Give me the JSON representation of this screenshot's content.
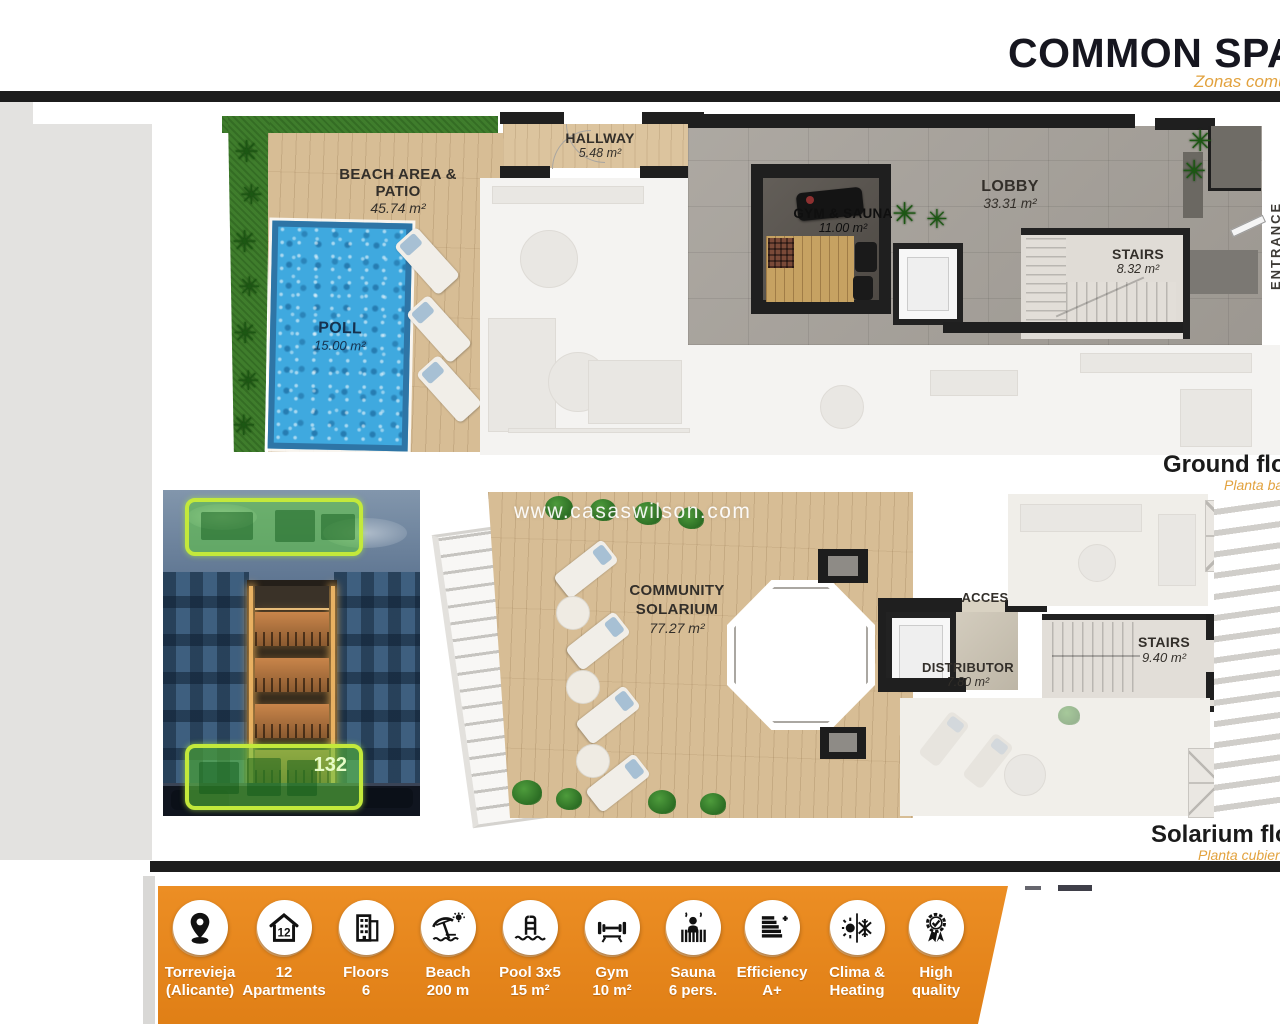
{
  "header": {
    "title": "COMMON SPACES",
    "subtitle": "Zonas comunes"
  },
  "watermark": "www.casaswilson.com",
  "ground_floor": {
    "floor_label": "Ground floor",
    "floor_sublabel": "Planta baja",
    "rooms": {
      "beach": {
        "name": "BEACH AREA & PATIO",
        "area": "45.74 m²"
      },
      "pool": {
        "name": "POLL",
        "area": "15.00 m²"
      },
      "hallway": {
        "name": "HALLWAY",
        "area": "5.48 m²"
      },
      "gym": {
        "name": "GYM & SAUNA",
        "area": "11.00 m²"
      },
      "lobby": {
        "name": "LOBBY",
        "area": "33.31 m²"
      },
      "stairs": {
        "name": "STAIRS",
        "area": "8.32 m²"
      },
      "entrance": {
        "name": "ENTRANCE"
      }
    }
  },
  "solarium_floor": {
    "floor_label": "Solarium floor",
    "floor_sublabel": "Planta cubierta",
    "rooms": {
      "solarium": {
        "name": "COMMUNITY SOLARIUM",
        "area": "77.27 m²"
      },
      "acces": {
        "name": "ACCES"
      },
      "distributor": {
        "name": "DISTRIBUTOR",
        "area": "7.80 m²"
      },
      "stairs": {
        "name": "STAIRS",
        "area": "9.40 m²"
      }
    }
  },
  "building_photo": {
    "badge": "132"
  },
  "features": [
    {
      "icon": "location-pin",
      "line1": "Torrevieja",
      "line2": "(Alicante)"
    },
    {
      "icon": "apartments",
      "line1": "12",
      "line2": "Apartments"
    },
    {
      "icon": "building-floors",
      "line1": "Floors",
      "line2": "6"
    },
    {
      "icon": "beach-umbrella",
      "line1": "Beach",
      "line2": "200 m"
    },
    {
      "icon": "pool-ladder",
      "line1": "Pool 3x5",
      "line2": "15 m²"
    },
    {
      "icon": "gym-barbell",
      "line1": "Gym",
      "line2": "10 m²"
    },
    {
      "icon": "sauna",
      "line1": "Sauna",
      "line2": "6 pers."
    },
    {
      "icon": "efficiency",
      "line1": "Efficiency",
      "line2": "A+"
    },
    {
      "icon": "clima-heating",
      "line1": "Clima &",
      "line2": "Heating"
    },
    {
      "icon": "high-quality",
      "line1": "High",
      "line2": "quality"
    }
  ],
  "colors": {
    "accent_orange": "#E8851C",
    "subtitle_orange": "#E2A23E",
    "highlight_green": "#C3E93B",
    "title_dark": "#16161F"
  }
}
